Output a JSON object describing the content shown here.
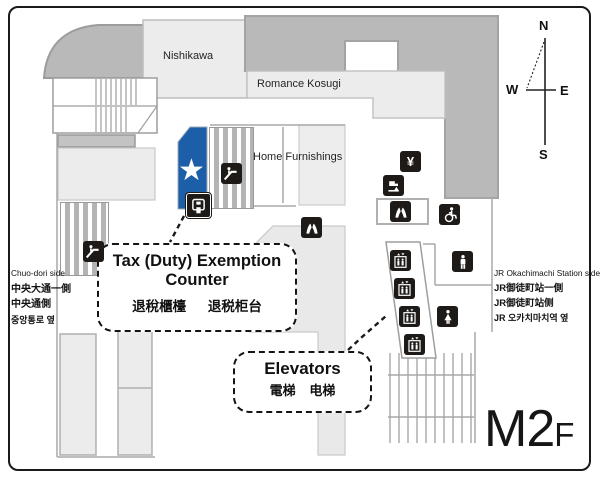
{
  "floor_indicator": {
    "main": "M2",
    "suffix": "F"
  },
  "areas": {
    "nishikawa": "Nishikawa",
    "romance_kosugi": "Romance Kosugi",
    "home_furnishings": "Home Furnishings"
  },
  "annotations": {
    "tax_counter": {
      "title_line1": "Tax (Duty) Exemption",
      "title_line2": "Counter",
      "zh_traditional": "退稅櫃檯",
      "zh_simplified": "退税柜台"
    },
    "elevators": {
      "title": "Elevators",
      "zh_traditional": "電梯",
      "zh_simplified": "电梯"
    }
  },
  "side_labels": {
    "left": {
      "en": "Chuo-dori side",
      "zh_traditional": "中央大通一側",
      "zh_simplified": "中央通側",
      "ko": "중앙통로 옆"
    },
    "right": {
      "en": "JR Okachimachi Station side",
      "zh_traditional": "JR御徒町站一側",
      "zh_simplified": "JR御徒町站侧",
      "ko": "JR 오카치마치역 옆"
    }
  },
  "compass": {
    "north": "N",
    "south": "S",
    "east": "E",
    "west": "W"
  },
  "symbols": {
    "currency_exchange": "¥",
    "tax_counter_star": "★"
  },
  "icons": {
    "escalator": "css-shape",
    "elevator": "css-shape",
    "mens-restroom": "css-shape",
    "womens-restroom": "css-shape",
    "wheelchair-accessible": "css-shape",
    "currency-exchange": "¥",
    "drinking-fountain": "css-shape",
    "hand-washing": "css-shape",
    "tax-refund-machine": "css-shape"
  },
  "colors": {
    "tax_area_blue": "#1c5fa8",
    "building_dark_gray": "#b9b9b9",
    "building_light_gray": "#ececec",
    "icon_black": "#1d1a17"
  }
}
